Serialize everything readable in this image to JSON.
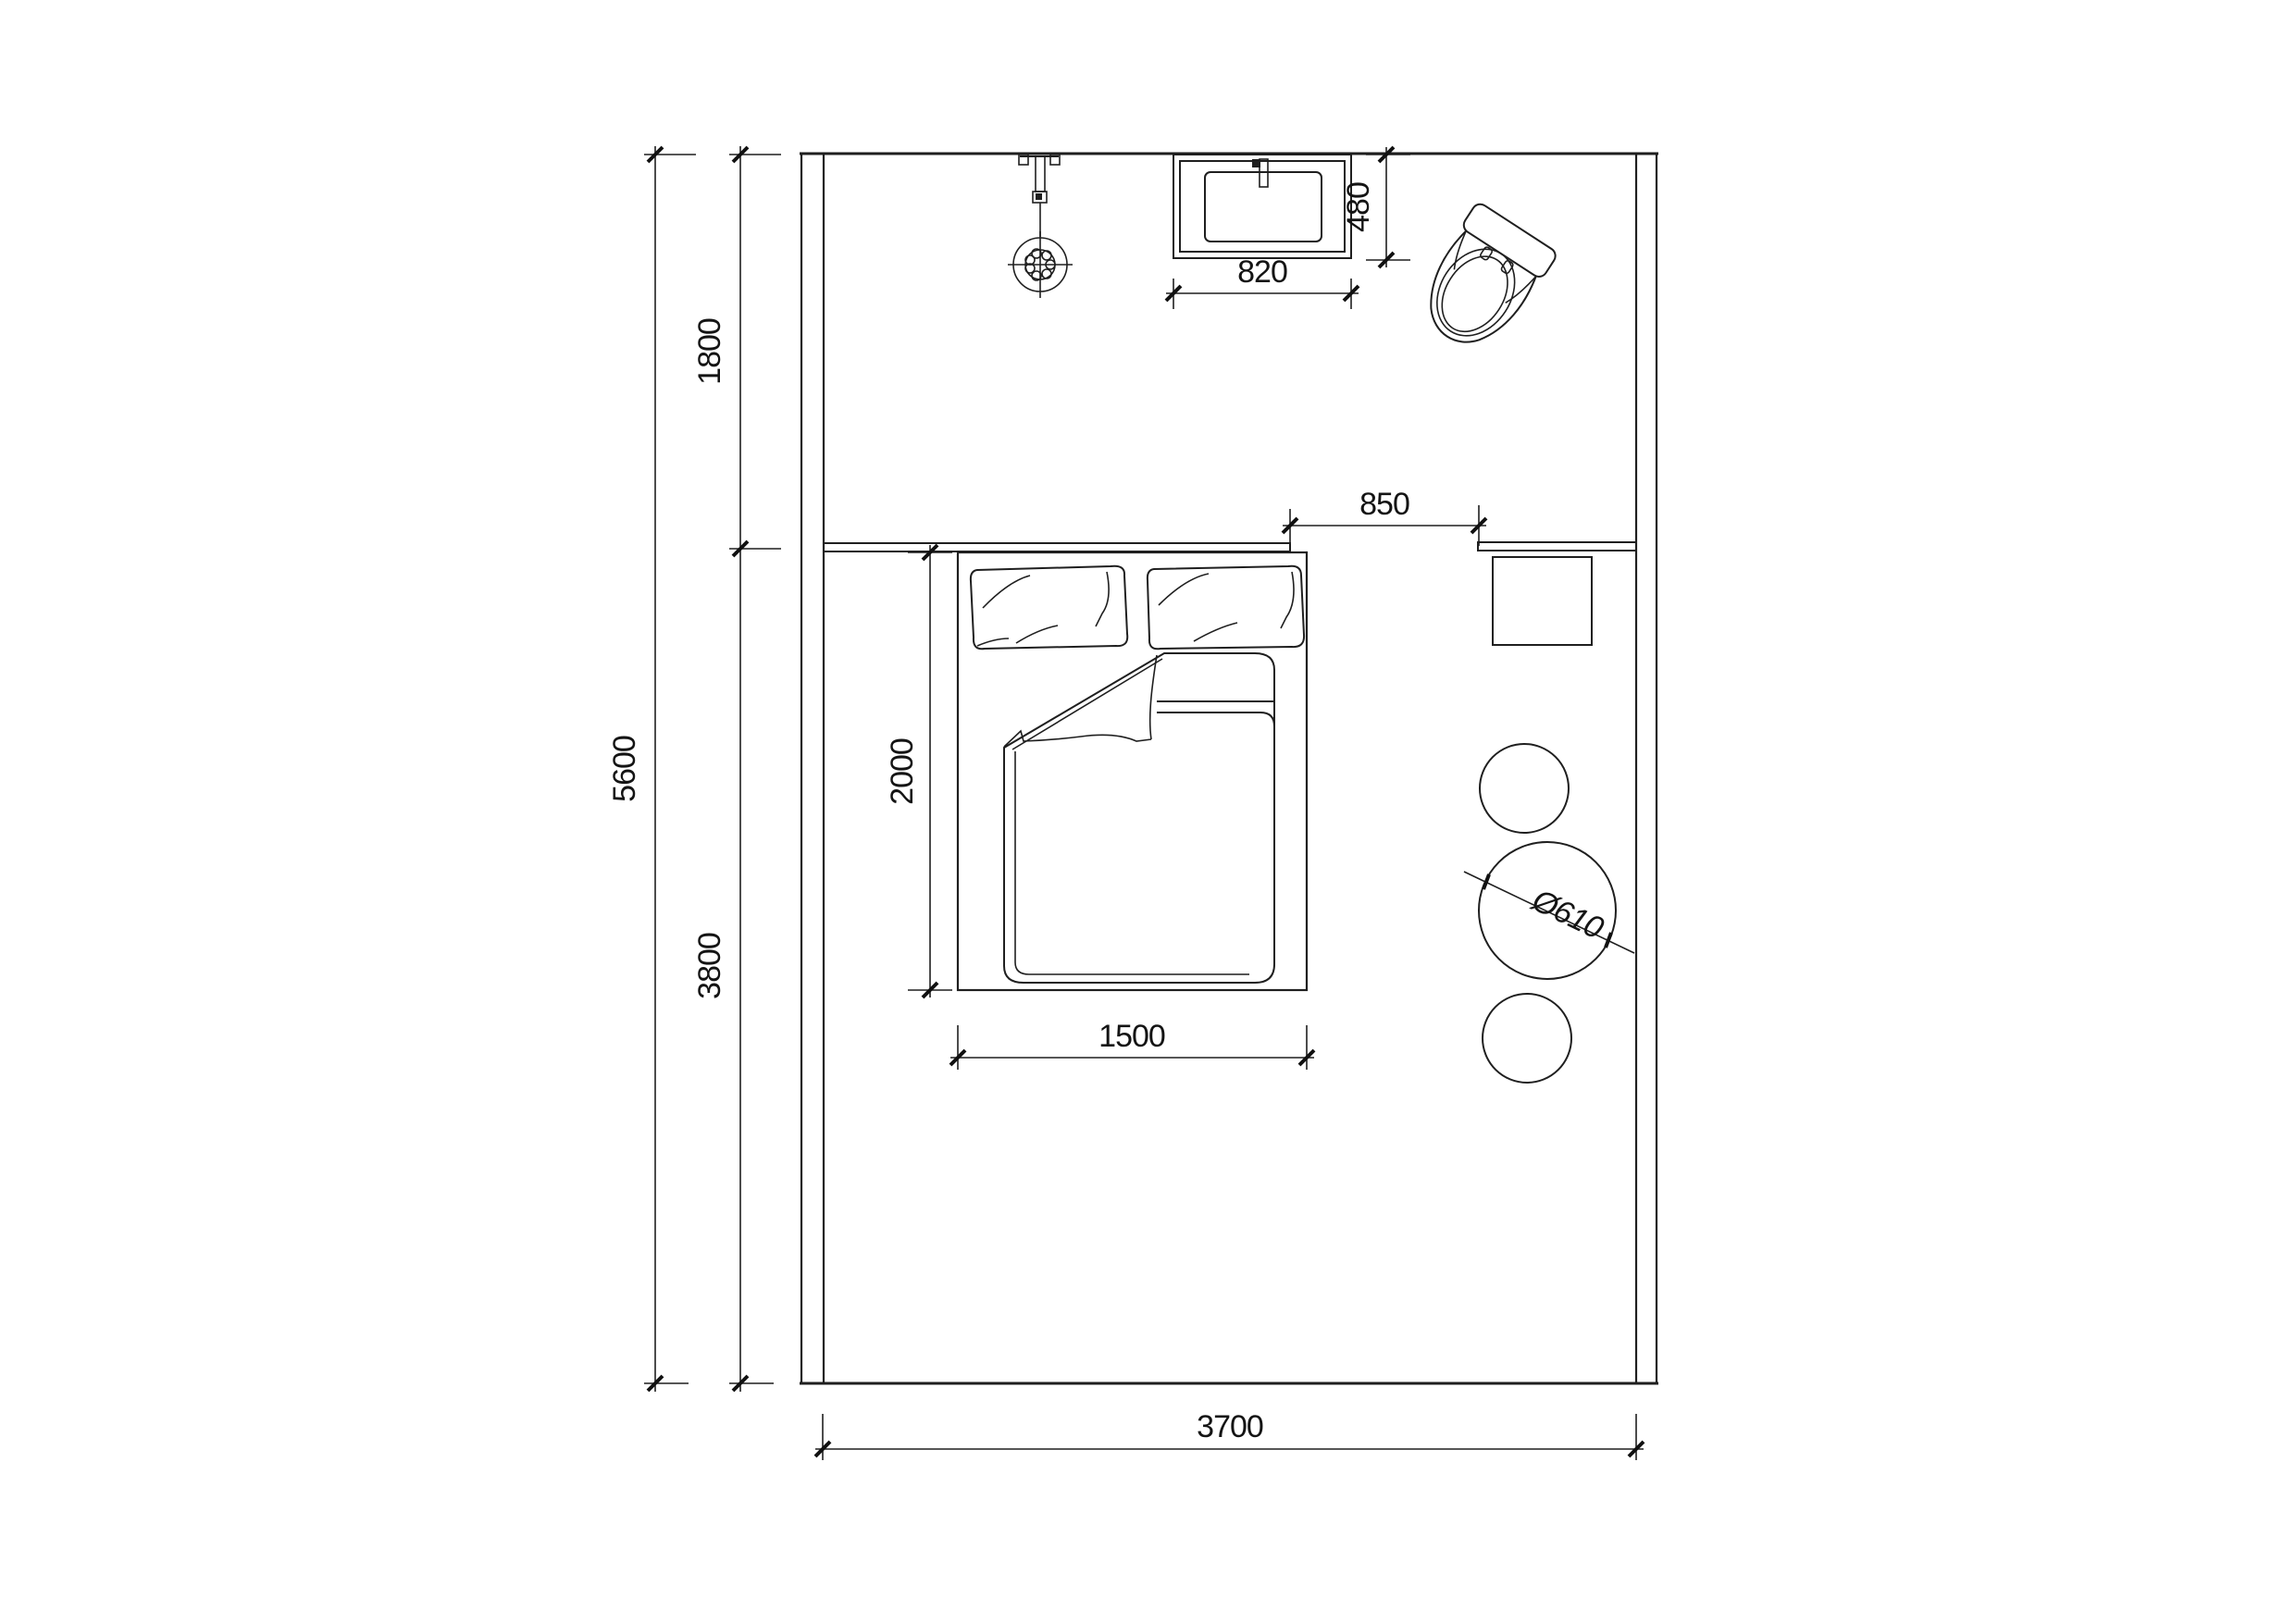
{
  "drawing": {
    "background": "#ffffff",
    "line_color": "#1f1f1f",
    "dimensions": {
      "total_height": "5600",
      "upper_zone": "1800",
      "lower_zone": "3800",
      "bed_length": "2000",
      "bed_width": "1500",
      "opening_width": "850",
      "basin_width": "820",
      "basin_depth": "480",
      "room_width": "3700",
      "table_diameter": "Ø610"
    },
    "symbols": {
      "bed": "double-bed-plan-icon",
      "pillow_left": "pillow-icon",
      "pillow_right": "pillow-icon",
      "duvet": "folded-duvet-icon",
      "shower": "shower-head-icon",
      "basin": "wash-basin-icon",
      "toilet": "toilet-icon",
      "counter": "wall-counter-icon",
      "stool": "square-stool-icon",
      "round_table": "round-table-icon",
      "round_stools": "round-stool-icon"
    }
  }
}
